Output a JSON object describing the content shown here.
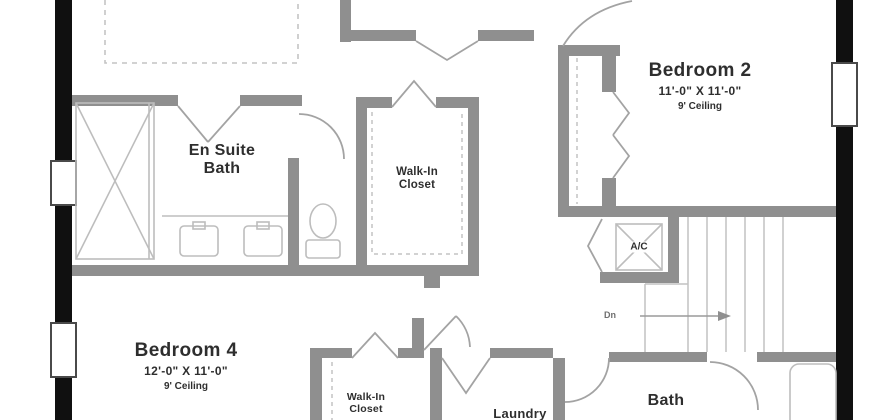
{
  "colors": {
    "exterior_wall": "#101010",
    "interior_wall": "#8f8f8f",
    "fixture_line": "#bdbdbd",
    "door_line": "#a3a3a3",
    "text": "#2e2e2e",
    "background": "#ffffff"
  },
  "rooms": {
    "bedroom2": {
      "name": "Bedroom 2",
      "dims": "11'-0\" X 11'-0\"",
      "ceiling": "9' Ceiling"
    },
    "bedroom4": {
      "name": "Bedroom 4",
      "dims": "12'-0\" X 11'-0\"",
      "ceiling": "9' Ceiling"
    },
    "en_suite": {
      "line1": "En Suite",
      "line2": "Bath"
    },
    "master_closet": {
      "line1": "Walk-In",
      "line2": "Closet"
    },
    "bedroom4_closet": {
      "line1": "Walk-In",
      "line2": "Closet"
    },
    "bath": {
      "name": "Bath"
    },
    "laundry": {
      "name": "Laundry"
    },
    "ac_closet": {
      "name": "A/C"
    }
  },
  "stairs": {
    "direction_label": "Dn"
  }
}
